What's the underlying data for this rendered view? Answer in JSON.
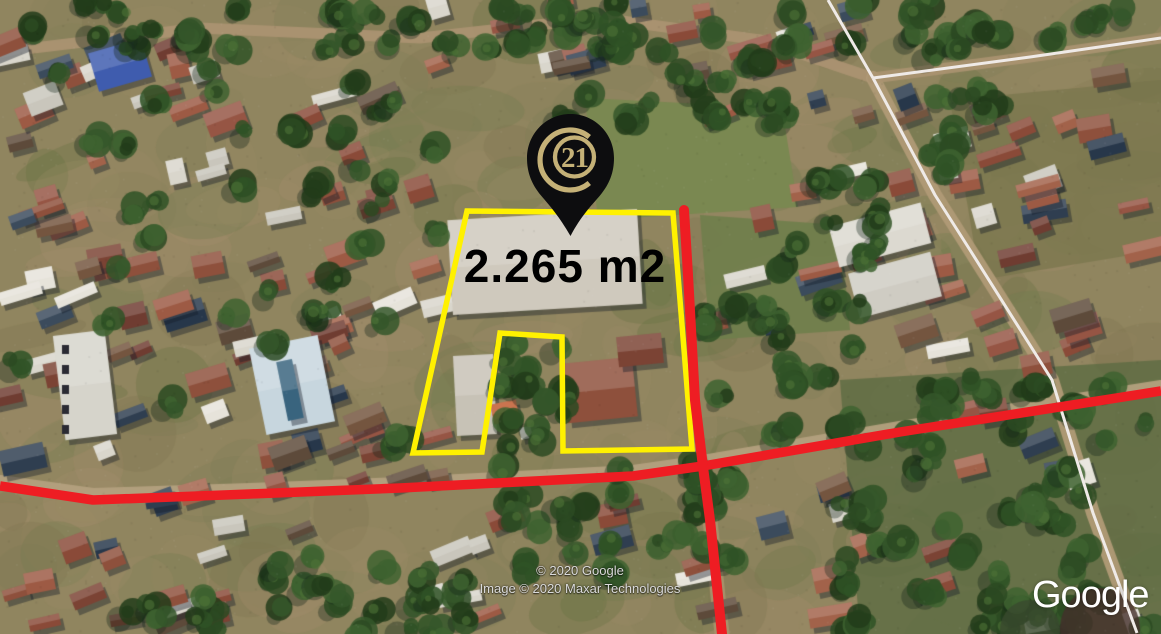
{
  "map": {
    "attribution": {
      "line1": "© 2020 Google",
      "line2": "Image © 2020 Maxar Technologies"
    },
    "watermark": "Google"
  },
  "annotations": {
    "area_label": "2.265 m2",
    "pin": {
      "icon": "century21-pin-icon",
      "number": "21"
    }
  },
  "colors": {
    "parcel_outline": "#FFF100",
    "highlight_road": "#EE1D23",
    "road_border": "#EFEAE7",
    "pin_body": "#0D0D0F",
    "pin_gold": "#C5B177",
    "area_text": "#000000",
    "attribution_text": "#DADADA",
    "watermark_text": "#FFFFFF"
  }
}
